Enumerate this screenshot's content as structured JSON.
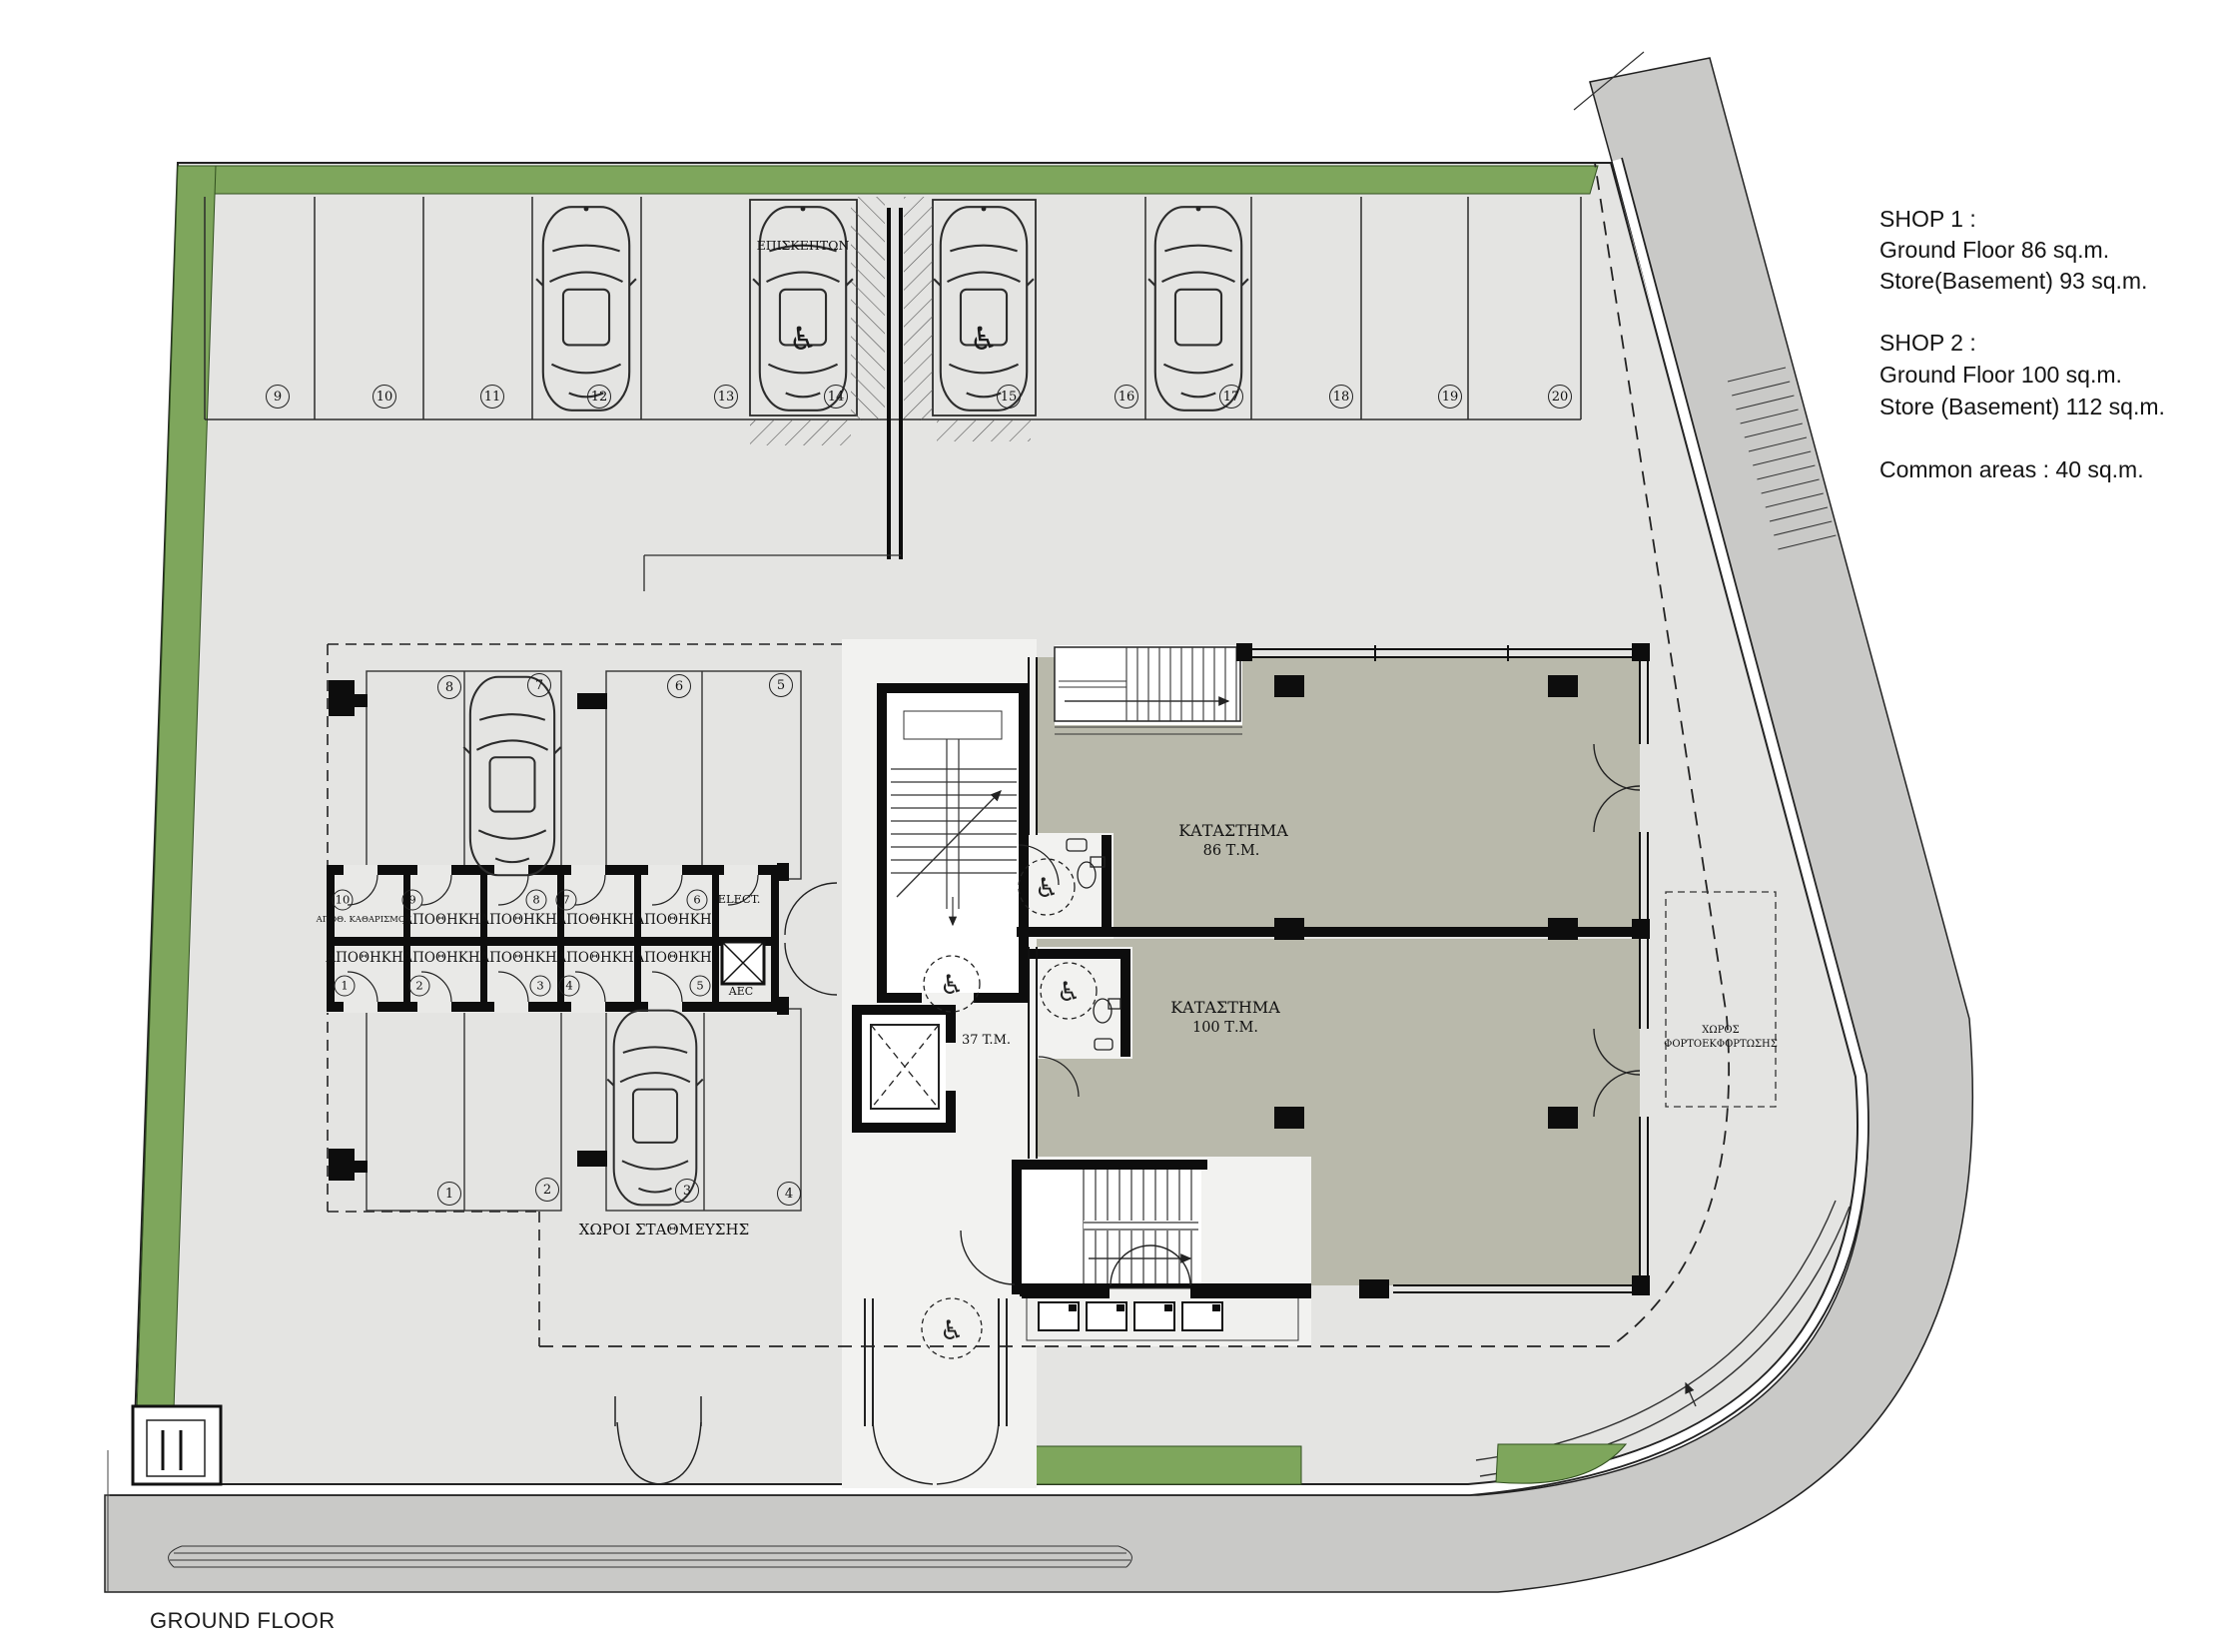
{
  "page": {
    "floor_label": "GROUND FLOOR"
  },
  "info_panel": {
    "lines": [
      "SHOP 1 :",
      "Ground Floor 86 sq.m.",
      "Store(Basement) 93 sq.m.",
      "SHOP 2 :",
      "Ground Floor 100 sq.m.",
      "Store (Basement) 112 sq.m.",
      "Common areas : 40 sq.m."
    ]
  },
  "parking": {
    "top_row_numbers": [
      "9",
      "10",
      "11",
      "12",
      "13",
      "14",
      "15",
      "16",
      "17",
      "18",
      "19",
      "20"
    ],
    "visitors_label": "ΕΠΙΣΚΕΠΤΩΝ",
    "inner_top_numbers": [
      "8",
      "7",
      "6",
      "5"
    ],
    "inner_bottom_numbers": [
      "1",
      "2",
      "3",
      "4"
    ],
    "area_label": "ΧΩΡΟΙ ΣΤΑΘΜΕΥΣΗΣ"
  },
  "storage": {
    "room_label": "ΑΠΟΘΗΚΗ",
    "cleaning_room_label": "ΑΠΟΘ. ΚΑΘΑΡΙΣΜΟΥ",
    "top_numbers": [
      "10",
      "9",
      "8",
      "7",
      "6"
    ],
    "bottom_numbers": [
      "1",
      "2",
      "3",
      "4",
      "5"
    ],
    "elect_label": "ELECT.",
    "shaft_label": "AEC"
  },
  "shops": {
    "shop1": {
      "name": "ΚΑΤΑΣΤΗΜΑ",
      "area": "86 Τ.Μ."
    },
    "shop2": {
      "name": "ΚΑΤΑΣΤΗΜΑ",
      "area": "100 Τ.Μ."
    },
    "lobby_area": "37 T.M."
  },
  "loading_area": {
    "line1": "ΧΩΡΟΣ",
    "line2": "ΦΟΡΤΟΕΚΦΟΡΤΩΣΗΣ"
  },
  "colors": {
    "green": "#7ea65c",
    "paving": "#e4e4e2",
    "road": "#c9c9c7",
    "shop_floor": "#b9b9ab",
    "wall": "#111111"
  }
}
